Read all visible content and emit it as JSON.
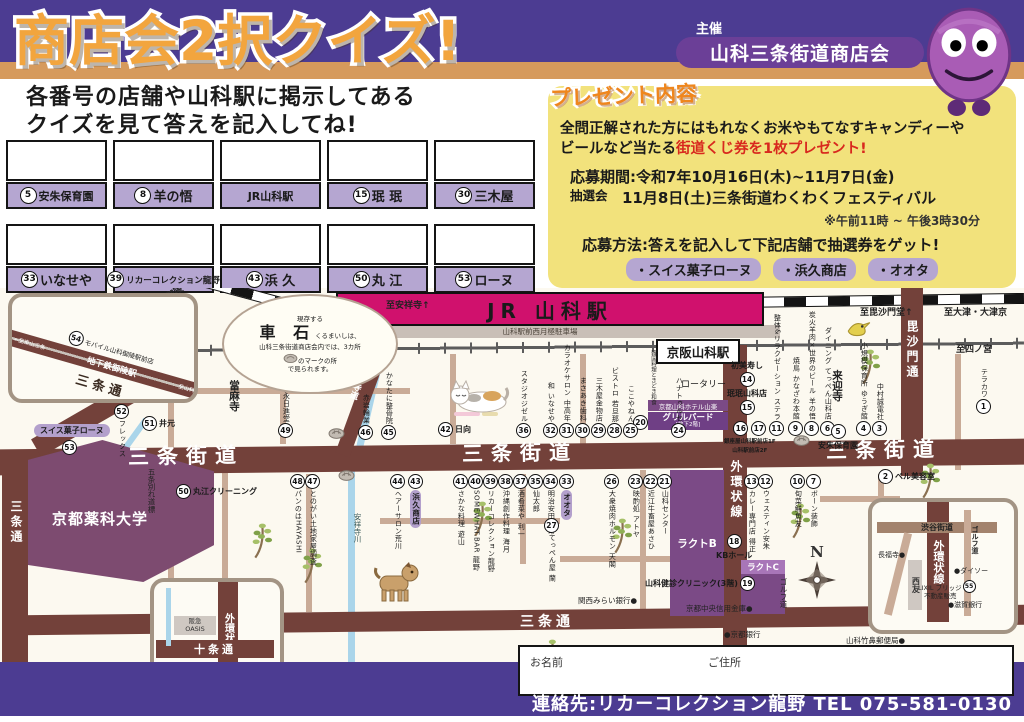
{
  "header": {
    "title": "商店会2択クイズ!",
    "organizer_label": "主催",
    "organizer": "山科三条街道商店会"
  },
  "intro": {
    "line1": "各番号の店舗や山科駅に掲示してある",
    "line2": "クイズを見て答えを記入してね!"
  },
  "answer_boxes": {
    "row1": [
      {
        "num": "5",
        "name": "安朱保育園"
      },
      {
        "num": "8",
        "name": "羊の悟"
      },
      {
        "num": "",
        "name": "JR山科駅"
      },
      {
        "num": "15",
        "name": "珉 珉"
      },
      {
        "num": "30",
        "name": "三木屋"
      }
    ],
    "row2": [
      {
        "num": "33",
        "name": "いなせや"
      },
      {
        "num": "39",
        "name": "リカーコレクション龍野"
      },
      {
        "num": "43",
        "name": "浜 久"
      },
      {
        "num": "50",
        "name": "丸 江"
      },
      {
        "num": "53",
        "name": "ローヌ"
      }
    ]
  },
  "prize": {
    "heading": "プレゼント内容",
    "body1": "全問正解された方にはもれなくお米やもてなすキャンディーや",
    "body2_black": "ビールなど当たる",
    "body2_red": "街道くじ券を1枚プレゼント!",
    "period": "応募期間:令和7年10月16日(木)~11月7日(金)",
    "lottery_label": "抽選会",
    "lottery": "11月8日(土)三条街道わくわくフェスティバル",
    "time_note": "※午前11時 ~ 午後3時30分",
    "method": "応募方法:答えを記入して下記店舗で抽選券をゲット!",
    "shops": [
      "・スイス菓子ローヌ",
      "・浜久商店",
      "・オオタ"
    ]
  },
  "map": {
    "stations": {
      "jr": "JR 山科駅",
      "keihan": "京阪山科駅",
      "parking": "山科駅前西月極駐車場",
      "rotary": "ロータリー"
    },
    "road_labels": [
      {
        "t": "三条街道",
        "x": 128,
        "y": 152,
        "c": "kaido"
      },
      {
        "t": "三条街道",
        "x": 462,
        "y": 149,
        "c": "kaido"
      },
      {
        "t": "三条街道",
        "x": 826,
        "y": 146,
        "c": "kaido"
      },
      {
        "t": "三条通",
        "x": 520,
        "y": 323,
        "c": "st-h"
      },
      {
        "t": "三条通",
        "x": 906,
        "y": 327,
        "c": "st-h"
      },
      {
        "t": "三条通",
        "x": 8,
        "y": 212,
        "c": "st-v"
      },
      {
        "t": "外環状線",
        "x": 728,
        "y": 172,
        "c": "st-v"
      },
      {
        "t": "毘沙門通",
        "x": 904,
        "y": 32,
        "c": "st-v"
      },
      {
        "t": "安祥寺道",
        "x": 352,
        "y": 78,
        "c": "st-v-sm"
      }
    ],
    "directions": [
      {
        "t": "←至御陵",
        "x": 150,
        "y": 2,
        "r": -33
      },
      {
        "t": "至京都",
        "x": 160,
        "y": 42,
        "r": 0
      },
      {
        "t": "至安祥寺↑",
        "x": 386,
        "y": 10,
        "r": 0
      },
      {
        "t": "至毘沙門堂↑",
        "x": 860,
        "y": 17,
        "r": 0
      },
      {
        "t": "至大津・大津京",
        "x": 944,
        "y": 17,
        "r": 0
      },
      {
        "t": "至四ノ宮",
        "x": 956,
        "y": 54,
        "r": 0
      }
    ],
    "shops_up": [
      {
        "n": "46",
        "t": "赤岩輪業",
        "x": 366,
        "y": 152
      },
      {
        "n": "45",
        "t": "かなたに整骨院",
        "x": 389,
        "y": 152
      },
      {
        "n": "49",
        "t": "福永日進堂",
        "x": 286,
        "y": 150
      },
      {
        "n": "36",
        "t": "スタジオジゼル",
        "x": 524,
        "y": 150
      },
      {
        "n": "32",
        "t": "和 いなせや",
        "x": 551,
        "y": 150
      },
      {
        "n": "31",
        "t": "カラオケサロン 中高年",
        "x": 567,
        "y": 150
      },
      {
        "n": "30",
        "t": "まさあき歯科",
        "x": 583,
        "y": 150
      },
      {
        "n": "29",
        "t": "三木屋金物店",
        "x": 599,
        "y": 150
      },
      {
        "n": "28",
        "t": "ビストロ 若旦那",
        "x": 615,
        "y": 150
      },
      {
        "n": "25",
        "t": "ここやねん",
        "x": 631,
        "y": 150
      },
      {
        "n": "24",
        "t": "ハナトゥルセ",
        "x": 679,
        "y": 150
      },
      {
        "n": "11",
        "t": "整体&リラクゼーション ステラ",
        "x": 777,
        "y": 148
      },
      {
        "n": "9",
        "t": "焼鳥 かなざわ本館",
        "x": 796,
        "y": 148
      },
      {
        "n": "8",
        "t": "炭火羊肉×世界のビール 羊の悟",
        "x": 812,
        "y": 148
      },
      {
        "n": "6",
        "t": "ダイニング てっぺん山科店",
        "x": 828,
        "y": 148
      },
      {
        "n": "4",
        "t": "小規模保育所 ゆうぎ館",
        "x": 864,
        "y": 148
      },
      {
        "n": "3",
        "t": "中村誠電社",
        "x": 880,
        "y": 148
      },
      {
        "n": "1",
        "t": "テラカワ",
        "x": 984,
        "y": 126
      }
    ],
    "shops_down": [
      {
        "n": "44",
        "t": "ヘアーサロン荒川",
        "x": 398,
        "y": 186
      },
      {
        "n": "43",
        "t": "浜久商店",
        "x": 416,
        "y": 186,
        "pill": true
      },
      {
        "n": "41",
        "t": "さかな料理 遊山",
        "x": 461,
        "y": 186
      },
      {
        "n": "40",
        "t": "SOMEWHAT.BAR 龍野",
        "x": 476,
        "y": 186
      },
      {
        "n": "39",
        "t": "リカーコレクション龍野",
        "x": 491,
        "y": 186
      },
      {
        "n": "38",
        "t": "沖縄創作料理 海月",
        "x": 506,
        "y": 186
      },
      {
        "n": "37",
        "t": "酒肴菜や 利一",
        "x": 521,
        "y": 186
      },
      {
        "n": "35",
        "t": "仙太郎",
        "x": 536,
        "y": 186
      },
      {
        "n": "34",
        "t": "明治安田生命",
        "x": 551,
        "y": 186
      },
      {
        "n": "33",
        "t": "オオタ",
        "x": 567,
        "y": 186,
        "pill": true
      },
      {
        "n": "27",
        "t": "てっぺん屋 蘭",
        "x": 552,
        "y": 230
      },
      {
        "n": "26",
        "t": "大衆焼肉ホルモン 天閣",
        "x": 612,
        "y": 186
      },
      {
        "n": "23",
        "t": "映酌処 アトヤ",
        "x": 636,
        "y": 186
      },
      {
        "n": "22",
        "t": "近江牛畜屋あさひ",
        "x": 651,
        "y": 186
      },
      {
        "n": "21",
        "t": "山科センター",
        "x": 665,
        "y": 186
      },
      {
        "n": "13",
        "t": "カレー専門店 得正",
        "x": 752,
        "y": 186
      },
      {
        "n": "12",
        "t": "ウェスティン安朱",
        "x": 766,
        "y": 186
      },
      {
        "n": "10",
        "t": "旬菜鮮魚友",
        "x": 798,
        "y": 186
      },
      {
        "n": "7",
        "t": "ボーン装飾",
        "x": 814,
        "y": 186
      },
      {
        "n": "52",
        "t": "フレックス",
        "x": 122,
        "y": 116
      },
      {
        "n": "48",
        "t": "パンのはHAYASHI",
        "x": 298,
        "y": 186
      },
      {
        "n": "47",
        "t": "とのがい土地家屋調査",
        "x": 313,
        "y": 186
      }
    ],
    "shops_h": [
      {
        "n": "51",
        "t": "井元",
        "x": 142,
        "y": 128
      },
      {
        "n": "50",
        "t": "丸江クリーニング",
        "x": 176,
        "y": 196
      },
      {
        "n": "42",
        "t": "日向",
        "x": 438,
        "y": 134
      },
      {
        "n": "2",
        "t": "ベル美容室",
        "x": 878,
        "y": 181
      },
      {
        "n": "18",
        "t": "KBホール",
        "x": 716,
        "y": 246,
        "mode": "nAbove"
      },
      {
        "n": "19",
        "t": "山科健診クリニック(3階)",
        "x": 645,
        "y": 288,
        "mode": "nAfter"
      },
      {
        "n": "14",
        "t": "初美寿し",
        "x": 731,
        "y": 72,
        "mode": "nBelow"
      },
      {
        "n": "15",
        "t": "珉珉山科店",
        "x": 727,
        "y": 100,
        "mode": "nBelow"
      },
      {
        "n": "5",
        "t": "安朱保育園",
        "x": 818,
        "y": 136,
        "mode": "nAbove"
      }
    ],
    "plain": [
      {
        "t": "五条別れ道標",
        "x": 146,
        "y": 180,
        "v": true
      },
      {
        "t": "安祥寺川",
        "x": 352,
        "y": 225,
        "v": true,
        "riv": true
      },
      {
        "t": "ゴルフ道",
        "x": 778,
        "y": 290,
        "v": true
      },
      {
        "t": "韓国料理ときどき和食",
        "x": 649,
        "y": 62,
        "v": true,
        "tiny": true
      },
      {
        "t": "来迎寺",
        "x": 830,
        "y": 82,
        "v": true,
        "big": true
      },
      {
        "t": "當麻寺",
        "x": 227,
        "y": 92,
        "v": true,
        "big": true
      },
      {
        "t": "関西みらい銀行●",
        "x": 578,
        "y": 307
      },
      {
        "t": "京都中央信用金庫●",
        "x": 686,
        "y": 315
      },
      {
        "t": "●京都銀行",
        "x": 724,
        "y": 341
      },
      {
        "t": "山科竹鼻郵便局●",
        "x": 846,
        "y": 347
      }
    ],
    "ginza": {
      "n1": "16",
      "n2": "17",
      "l1": "銀座屋山科駅前店1F",
      "l2": "山科駅前店2F",
      "x": 724,
      "y": 133
    },
    "rhone": {
      "t": "スイス菓子ローヌ",
      "n": "53",
      "x": 34,
      "y": 136
    },
    "hotel": {
      "t": "京都山科ホテル山楽"
    },
    "grill": {
      "n": "20",
      "t": "グリルバード",
      "sub": "[地下2階]"
    },
    "lact_b": "ラクトB",
    "lact_c": "ラクトC",
    "yakka": "京都薬科大学",
    "cloud": {
      "s1": "現存する",
      "big": "車 石",
      "s2": "くるまいしは、",
      "l1": "山科三条街道商店会内では、3カ所",
      "l2": "のマークの所",
      "l3": "で見られます。"
    },
    "inset1": {
      "n": "54",
      "shop": "モバイル山科御陵駅前店",
      "station": "地下鉄御陵駅",
      "road": "三条通",
      "dirL": "←至東山三条",
      "dirR": "至山科→"
    },
    "inset2": {
      "r1": "渋谷街道",
      "r2": "外環状線",
      "golf": "ゴルフ道",
      "temple": "長福寺●",
      "seiyu": "西友",
      "daiso": "●ダイソー",
      "lixil1": "LIXIL ブリッジ",
      "lixil_n": "55",
      "lixil2": "不動産販売",
      "shiga": "●滋賀銀行"
    },
    "inset3": {
      "r1": "外環状線",
      "r2": "十条通",
      "hankyu": "阪急",
      "oasis": "OASIS",
      "n": "56",
      "t": "インサイトハウス"
    },
    "compass_n": "N"
  },
  "form": {
    "name_label": "お名前",
    "address_label": "ご住所"
  },
  "footer": {
    "contact": "連絡先:リカーコレクション龍野 TEL 075-581-0130"
  }
}
